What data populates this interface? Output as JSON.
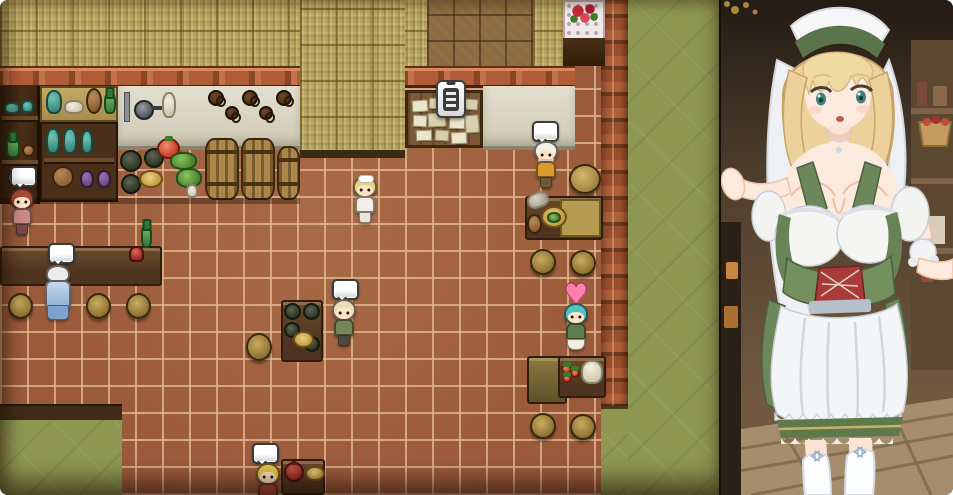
{
  "screen": {
    "width_px": 953,
    "height_px": 495,
    "kind": "game screenshot with character art side panel"
  },
  "game_view": {
    "scene": "top-down pixel-art tavern interior",
    "indicators": {
      "speech_bubble_glyph": "",
      "heart_glyph": "♥",
      "notice_board_marker": "clipboard"
    },
    "npcs": [
      {
        "id": "red-haired-villager",
        "indicator": "speech-bubble",
        "location": "upper-left by pottery shelves"
      },
      {
        "id": "blue-robed-patron",
        "indicator": "speech-bubble",
        "location": "standing at bar counter"
      },
      {
        "id": "blonde-waitress-player",
        "indicator": "none",
        "location": "center floor"
      },
      {
        "id": "turbaned-cook",
        "indicator": "speech-bubble",
        "location": "right, beside kitchen counter"
      },
      {
        "id": "bald-patron-green",
        "indicator": "speech-bubble",
        "location": "center, beside keg table"
      },
      {
        "id": "teal-haired-waitress",
        "indicator": "heart",
        "location": "right, beside food table"
      },
      {
        "id": "blonde-child-red",
        "indicator": "speech-bubble",
        "location": "bottom center by food table"
      }
    ],
    "objects": [
      "notice board with paper notes and clipboard marker",
      "rose bouquet on lace-covered table",
      "pottery and jar shelves",
      "hanging mugs",
      "wooden barrels",
      "bar counter with round stools",
      "keg table",
      "tables with pots, plates and produce"
    ]
  },
  "art_panel": {
    "subject": "blonde waitress in green dirndl with white apron and white head veil",
    "background": "wooden tavern wall, shelf with apple basket, plank floor"
  },
  "palette": {
    "floor_tile": "#9a5a3a",
    "floor_grout": "#d2a57c",
    "green_surface": "#8d9751",
    "straw_wall": "#b3a35f",
    "brick_trim": "#b05c38",
    "wood_dark": "#4e3420",
    "counter_white": "#d8d4c2",
    "heart_pink": "#ff7fae",
    "bubble_fill": "#ffffff",
    "dress_green": "#6f8a59",
    "lacing_red": "#a83c3c",
    "hair_blonde": "#edd49c"
  }
}
